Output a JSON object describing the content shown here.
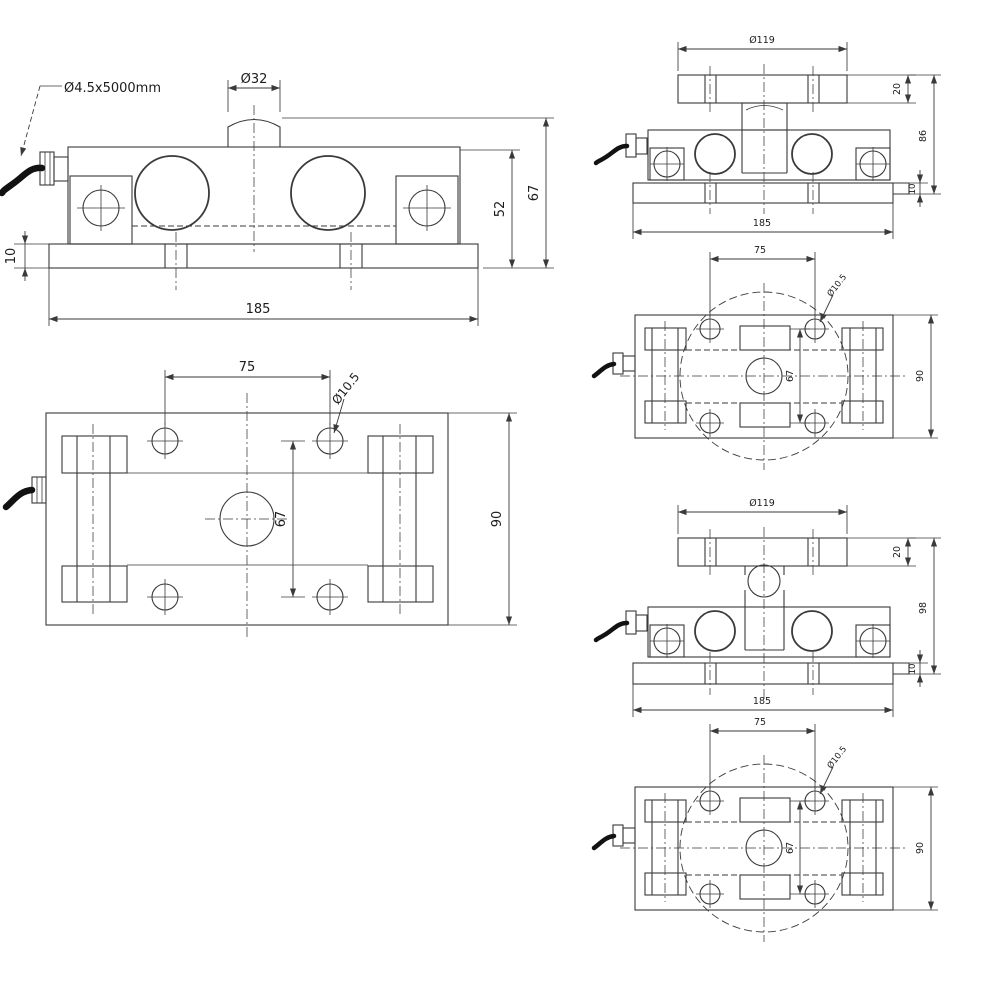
{
  "colors": {
    "line": "#3a3a3a",
    "cable": "#121212",
    "text": "#1c1c1c",
    "background": "#ffffff"
  },
  "views": {
    "side": {
      "cable": "Ø4.5x5000mm",
      "button_dia": "Ø32",
      "height_to_base": "52",
      "height_total": "67",
      "base_thk": "10",
      "length": "185"
    },
    "plan": {
      "pitch_x": "75",
      "hole_dia": "Ø10.5",
      "pitch_y": "67",
      "width": "90"
    },
    "flat_side": {
      "plate_dia": "Ø119",
      "plate_thk": "20",
      "height": "86",
      "base_thk": "10",
      "length": "185"
    },
    "flat_plan": {
      "pitch_x": "75",
      "hole_dia": "Ø10.5",
      "pitch_y": "67",
      "width": "90"
    },
    "ball_side": {
      "plate_dia": "Ø119",
      "plate_thk": "20",
      "height": "98",
      "base_thk": "10",
      "length": "185"
    },
    "ball_plan": {
      "pitch_x": "75",
      "hole_dia": "Ø10.5",
      "pitch_y": "67",
      "width": "90"
    }
  }
}
